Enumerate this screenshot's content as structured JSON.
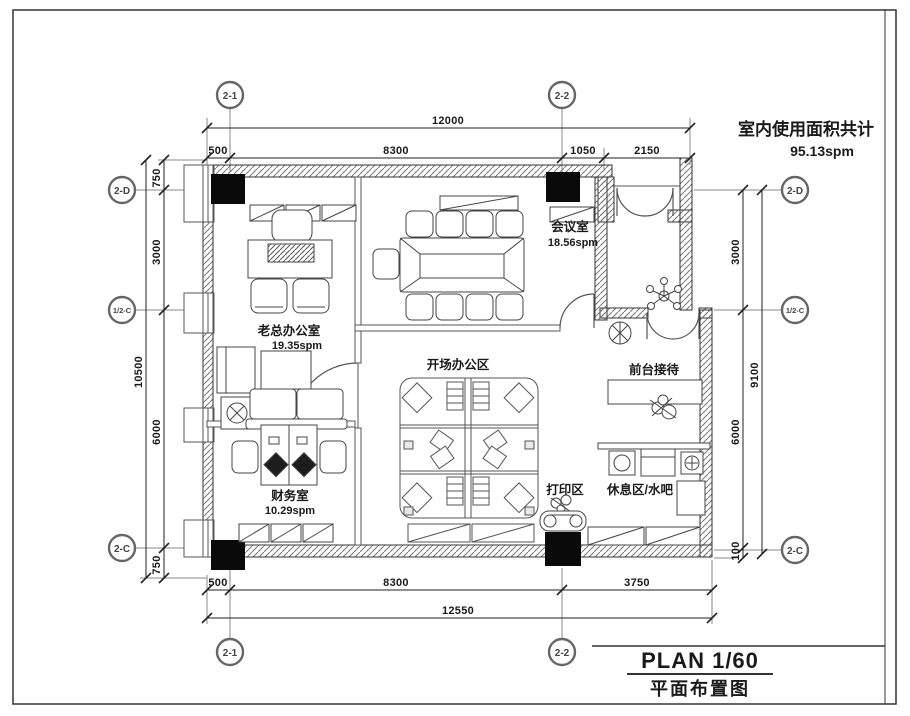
{
  "sheet": {
    "area_note": {
      "line1": "室内使用面积共计",
      "line2": "95.13spm"
    },
    "title_block": {
      "plan": "PLAN 1/60",
      "subtitle": "平面布置图"
    }
  },
  "grid_bubbles": {
    "top": [
      "2-1",
      "2-2"
    ],
    "bottom": [
      "2-1",
      "2-2"
    ],
    "left": [
      "2-D",
      "1/2-C",
      "2-C"
    ],
    "right": [
      "2-D",
      "1/2-C",
      "2-C"
    ]
  },
  "dimensions": {
    "top_overall": "12000",
    "top_segments": [
      "500",
      "8300",
      "1050",
      "2150"
    ],
    "bottom_segments": [
      "500",
      "8300",
      "3750"
    ],
    "bottom_overall": "12550",
    "left_segments": [
      "750",
      "3000",
      "6000",
      "750"
    ],
    "left_overall": "10500",
    "right_segments": [
      "3000",
      "6000",
      "100"
    ],
    "right_overall": "9100"
  },
  "rooms": {
    "boss_office": {
      "name": "老总办公室",
      "area": "19.35spm"
    },
    "meeting_room": {
      "name": "会议室",
      "area": "18.56spm"
    },
    "finance_room": {
      "name": "财务室",
      "area": "10.29spm"
    },
    "open_office": {
      "name": "开场办公区"
    },
    "print_area": {
      "name": "打印区"
    },
    "rest_area": {
      "name": "休息区/水吧"
    },
    "reception": {
      "name": "前台接待"
    }
  }
}
